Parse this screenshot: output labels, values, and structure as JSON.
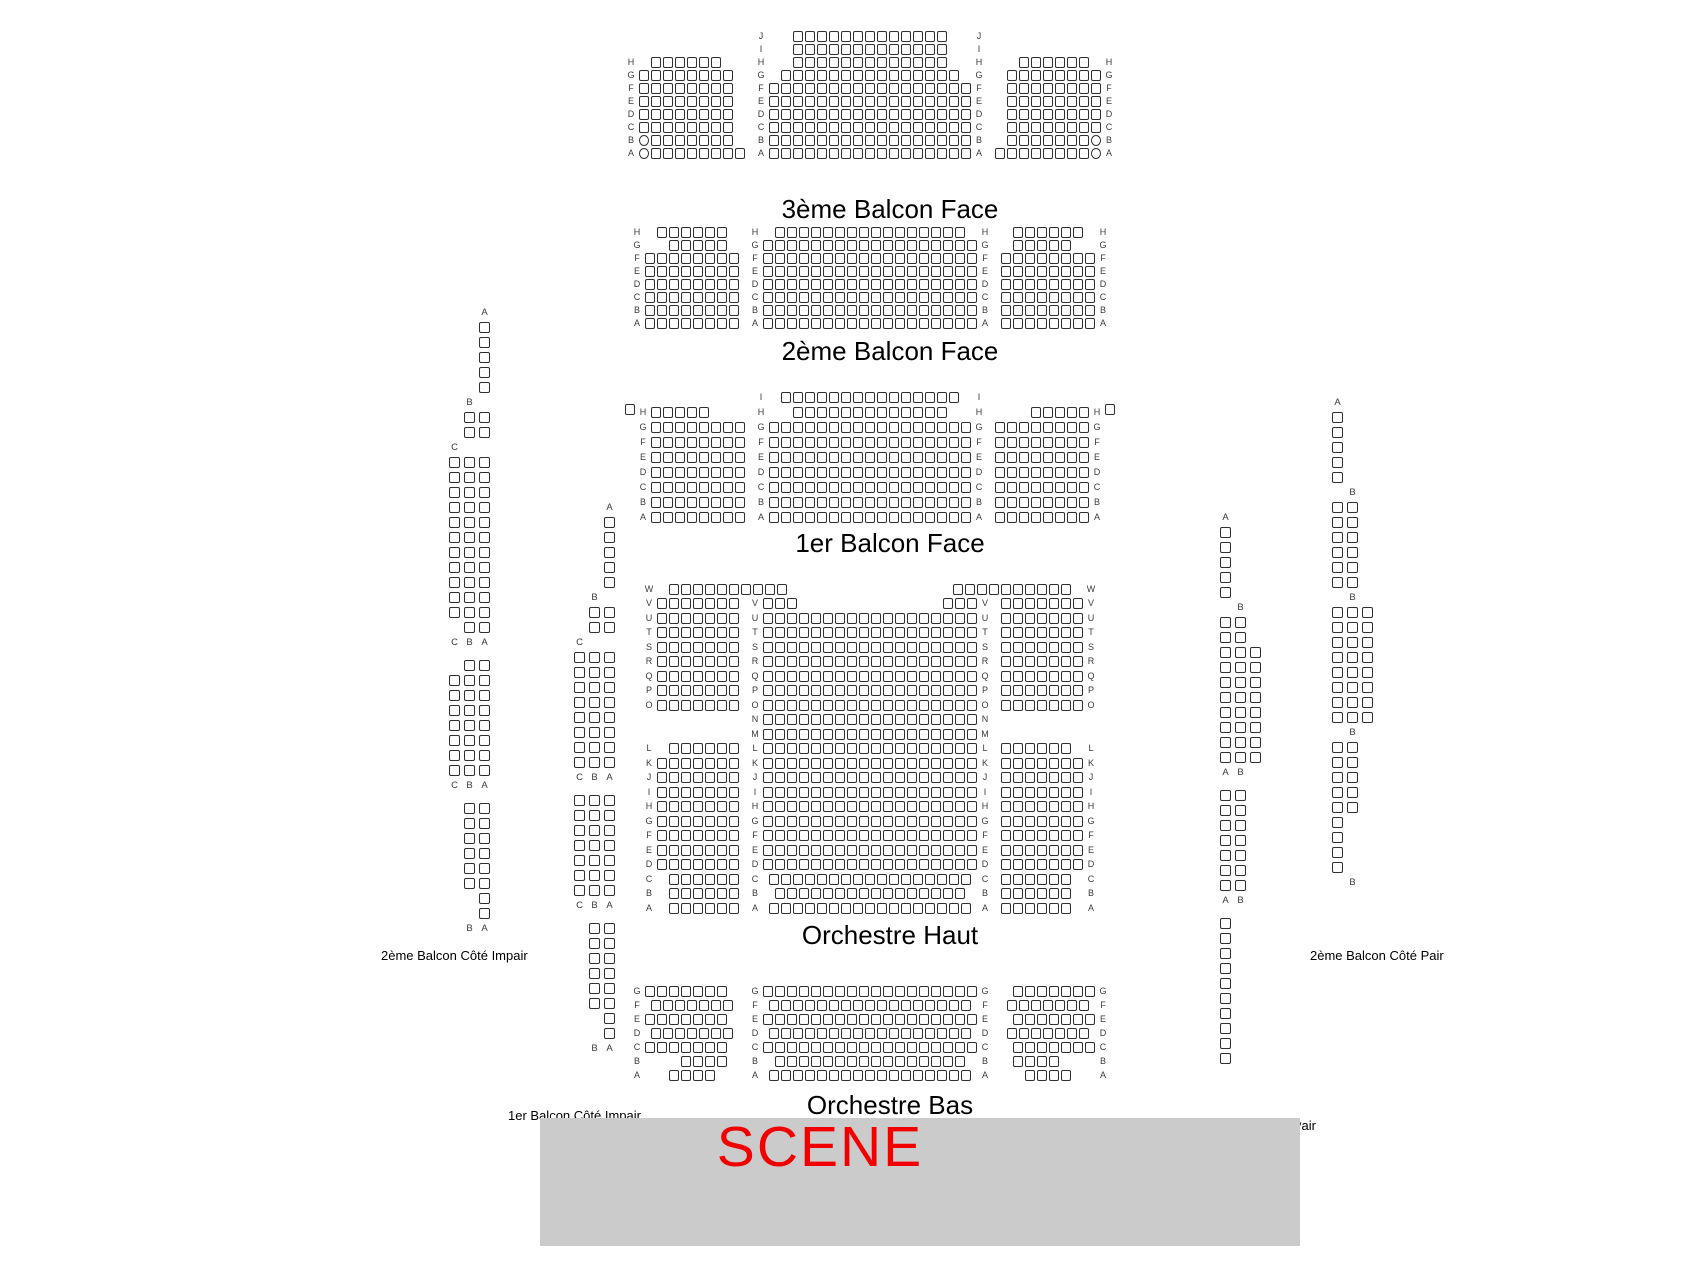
{
  "colors": {
    "stage_bg": "#cbcbcb",
    "scene_red": "#f20000",
    "seat_border": "#2f2f2f"
  },
  "stage": {
    "label": "SCENE"
  },
  "sections": [
    {
      "id": "balcon3",
      "title": "3ème Balcon Face",
      "blocks": [
        {
          "pos": "left",
          "cols": 9,
          "rows": [
            {
              "l": "H",
              "o": 1,
              "n": 6
            },
            {
              "l": "G",
              "n": 8
            },
            {
              "l": "F",
              "n": 8
            },
            {
              "l": "E",
              "n": 8
            },
            {
              "l": "D",
              "n": 8
            },
            {
              "l": "C",
              "n": 8
            },
            {
              "l": "B",
              "n": 7,
              "rl": 1
            },
            {
              "l": "A",
              "n": 8,
              "rl": 1
            }
          ]
        },
        {
          "pos": "center",
          "cols": 17,
          "rows": [
            {
              "l": "J",
              "n": 13
            },
            {
              "l": "I",
              "n": 13
            },
            {
              "l": "H",
              "n": 13
            },
            {
              "l": "G",
              "n": 15
            },
            {
              "l": "F",
              "n": 17
            },
            {
              "l": "E",
              "n": 17
            },
            {
              "l": "D",
              "n": 17
            },
            {
              "l": "C",
              "n": 17
            },
            {
              "l": "B",
              "n": 17
            },
            {
              "l": "A",
              "n": 17
            }
          ]
        },
        {
          "pos": "right",
          "cols": 9,
          "rows": [
            {
              "l": "H",
              "o": 1,
              "n": 6
            },
            {
              "l": "G",
              "n": 8
            },
            {
              "l": "F",
              "n": 8
            },
            {
              "l": "E",
              "n": 8
            },
            {
              "l": "D",
              "n": 8
            },
            {
              "l": "C",
              "n": 8
            },
            {
              "l": "B",
              "n": 7,
              "rr": 1
            },
            {
              "l": "A",
              "n": 8,
              "rr": 1
            }
          ]
        }
      ]
    },
    {
      "id": "balcon2",
      "title": "2ème Balcon Face",
      "blocks": [
        {
          "pos": "left",
          "cols": 8,
          "rows": [
            {
              "l": "H",
              "o": 1,
              "n": 6
            },
            {
              "l": "G",
              "o": 2,
              "n": 5
            },
            {
              "l": "F",
              "n": 8
            },
            {
              "l": "E",
              "n": 8
            },
            {
              "l": "D",
              "n": 8
            },
            {
              "l": "C",
              "n": 8
            },
            {
              "l": "B",
              "n": 8
            },
            {
              "l": "A",
              "n": 8
            }
          ]
        },
        {
          "pos": "center",
          "cols": 18,
          "rows": [
            {
              "l": "H",
              "n": 16
            },
            {
              "l": "G",
              "n": 18
            },
            {
              "l": "F",
              "n": 18
            },
            {
              "l": "E",
              "n": 18
            },
            {
              "l": "D",
              "n": 18
            },
            {
              "l": "C",
              "n": 18
            },
            {
              "l": "B",
              "n": 18
            },
            {
              "l": "A",
              "n": 18
            }
          ]
        },
        {
          "pos": "right",
          "cols": 8,
          "rows": [
            {
              "l": "H",
              "o": 1,
              "n": 6
            },
            {
              "l": "G",
              "o": 2,
              "n": 5
            },
            {
              "l": "F",
              "n": 8
            },
            {
              "l": "E",
              "n": 8
            },
            {
              "l": "D",
              "n": 8
            },
            {
              "l": "C",
              "n": 8
            },
            {
              "l": "B",
              "n": 8
            },
            {
              "l": "A",
              "n": 8
            }
          ]
        }
      ]
    },
    {
      "id": "balcon1",
      "title": "1er Balcon Face",
      "lone_seats": 2,
      "blocks": [
        {
          "pos": "left",
          "cols": 8,
          "rows": [
            {
              "l": "H",
              "n": 5
            },
            {
              "l": "G",
              "n": 8
            },
            {
              "l": "F",
              "n": 8
            },
            {
              "l": "E",
              "n": 8
            },
            {
              "l": "D",
              "n": 8
            },
            {
              "l": "C",
              "n": 8
            },
            {
              "l": "B",
              "n": 8
            },
            {
              "l": "A",
              "n": 8
            }
          ]
        },
        {
          "pos": "center",
          "cols": 17,
          "rows": [
            {
              "l": "I",
              "n": 15
            },
            {
              "l": "H",
              "n": 13
            },
            {
              "l": "G",
              "n": 17
            },
            {
              "l": "F",
              "n": 17
            },
            {
              "l": "E",
              "n": 17
            },
            {
              "l": "D",
              "n": 17
            },
            {
              "l": "C",
              "n": 17
            },
            {
              "l": "B",
              "n": 17
            },
            {
              "l": "A",
              "n": 17
            }
          ]
        },
        {
          "pos": "right",
          "cols": 8,
          "rows": [
            {
              "l": "H",
              "n": 5
            },
            {
              "l": "G",
              "n": 8
            },
            {
              "l": "F",
              "n": 8
            },
            {
              "l": "E",
              "n": 8
            },
            {
              "l": "D",
              "n": 8
            },
            {
              "l": "C",
              "n": 8
            },
            {
              "l": "B",
              "n": 8
            },
            {
              "l": "A",
              "n": 8
            }
          ]
        }
      ]
    },
    {
      "id": "orch-haut",
      "title": "Orchestre Haut",
      "blocks": [
        {
          "pos": "left",
          "cols": 7,
          "rows": [
            {
              "l": "W",
              "o": 1,
              "n": 10
            },
            {
              "l": "V",
              "n": 7
            },
            {
              "l": "U",
              "n": 7
            },
            {
              "l": "T",
              "n": 7
            },
            {
              "l": "S",
              "n": 7
            },
            {
              "l": "R",
              "n": 7
            },
            {
              "l": "Q",
              "n": 7
            },
            {
              "l": "P",
              "n": 7
            },
            {
              "l": "O",
              "n": 7
            },
            {
              "sp": 2
            },
            {
              "l": "L",
              "o": 1,
              "n": 6
            },
            {
              "l": "K",
              "n": 7
            },
            {
              "l": "J",
              "n": 7
            },
            {
              "l": "I",
              "n": 7
            },
            {
              "l": "H",
              "n": 7
            },
            {
              "l": "G",
              "n": 7
            },
            {
              "l": "F",
              "n": 7
            },
            {
              "l": "E",
              "n": 7
            },
            {
              "l": "D",
              "n": 7
            },
            {
              "l": "C",
              "o": 1,
              "n": 6
            },
            {
              "l": "B",
              "o": 1,
              "n": 6
            },
            {
              "l": "A",
              "o": 1,
              "n": 6
            }
          ]
        },
        {
          "pos": "center",
          "cols": 18,
          "rows": [
            {
              "l": "V",
              "split": [
                3,
                3
              ]
            },
            {
              "l": "U",
              "n": 18
            },
            {
              "l": "T",
              "n": 18
            },
            {
              "l": "S",
              "n": 18
            },
            {
              "l": "R",
              "n": 18
            },
            {
              "l": "Q",
              "n": 18
            },
            {
              "l": "P",
              "n": 18
            },
            {
              "l": "O",
              "n": 18
            },
            {
              "l": "N",
              "n": 18
            },
            {
              "l": "M",
              "n": 18
            },
            {
              "l": "L",
              "n": 18
            },
            {
              "l": "K",
              "n": 18
            },
            {
              "l": "J",
              "n": 18
            },
            {
              "l": "I",
              "n": 18
            },
            {
              "l": "H",
              "n": 18
            },
            {
              "l": "G",
              "n": 18
            },
            {
              "l": "F",
              "n": 18
            },
            {
              "l": "E",
              "n": 18
            },
            {
              "l": "D",
              "n": 18
            },
            {
              "l": "C",
              "n": 17
            },
            {
              "l": "B",
              "n": 16
            },
            {
              "l": "A",
              "n": 17
            }
          ]
        },
        {
          "pos": "right",
          "cols": 7,
          "rows": [
            {
              "l": "W",
              "o": 1,
              "n": 10
            },
            {
              "l": "V",
              "n": 7
            },
            {
              "l": "U",
              "n": 7
            },
            {
              "l": "T",
              "n": 7
            },
            {
              "l": "S",
              "n": 7
            },
            {
              "l": "R",
              "n": 7
            },
            {
              "l": "Q",
              "n": 7
            },
            {
              "l": "P",
              "n": 7
            },
            {
              "l": "O",
              "n": 7
            },
            {
              "sp": 2
            },
            {
              "l": "L",
              "o": 1,
              "n": 6
            },
            {
              "l": "K",
              "n": 7
            },
            {
              "l": "J",
              "n": 7
            },
            {
              "l": "I",
              "n": 7
            },
            {
              "l": "H",
              "n": 7
            },
            {
              "l": "G",
              "n": 7
            },
            {
              "l": "F",
              "n": 7
            },
            {
              "l": "E",
              "n": 7
            },
            {
              "l": "D",
              "n": 7
            },
            {
              "l": "C",
              "o": 1,
              "n": 6
            },
            {
              "l": "B",
              "o": 1,
              "n": 6
            },
            {
              "l": "A",
              "o": 1,
              "n": 6
            }
          ]
        }
      ]
    },
    {
      "id": "orch-bas",
      "title": "Orchestre Bas",
      "blocks": [
        {
          "pos": "left",
          "cols": 8,
          "rows": [
            {
              "l": "G",
              "n": 7
            },
            {
              "l": "F",
              "o": 0.5,
              "n": 7
            },
            {
              "l": "E",
              "n": 7
            },
            {
              "l": "D",
              "o": 0.5,
              "n": 7
            },
            {
              "l": "C",
              "n": 7
            },
            {
              "l": "B",
              "o": 3,
              "n": 4
            },
            {
              "l": "A",
              "o": 2,
              "n": 4
            }
          ]
        },
        {
          "pos": "center",
          "cols": 18,
          "rows": [
            {
              "l": "G",
              "n": 18
            },
            {
              "l": "F",
              "n": 17
            },
            {
              "l": "E",
              "n": 18
            },
            {
              "l": "D",
              "n": 17
            },
            {
              "l": "C",
              "n": 18
            },
            {
              "l": "B",
              "n": 16
            },
            {
              "l": "A",
              "n": 17
            }
          ]
        },
        {
          "pos": "right",
          "cols": 8,
          "rows": [
            {
              "l": "G",
              "n": 7
            },
            {
              "l": "F",
              "o": 0.5,
              "n": 7
            },
            {
              "l": "E",
              "n": 7
            },
            {
              "l": "D",
              "o": 0.5,
              "n": 7
            },
            {
              "l": "C",
              "n": 7
            },
            {
              "l": "B",
              "o": 3,
              "n": 4
            },
            {
              "l": "A",
              "o": 2,
              "n": 4
            }
          ]
        }
      ]
    }
  ],
  "strips": [
    {
      "id": "imp2",
      "title": "2ème Balcon Côté Impair",
      "items": [
        {
          "t": "lab",
          "ls": [
            "A"
          ],
          "dx": 0
        },
        {
          "t": "rows",
          "w": 1,
          "c": 5
        },
        {
          "t": "lab",
          "ls": [
            "B"
          ],
          "dx": 1
        },
        {
          "t": "rows",
          "w": 2,
          "c": 2
        },
        {
          "t": "lab",
          "ls": [
            "C"
          ],
          "dx": 2
        },
        {
          "t": "rows",
          "w": 3,
          "c": 11
        },
        {
          "t": "rows",
          "w": 2,
          "c": 1
        },
        {
          "t": "lab",
          "ls": [
            "C",
            "B",
            "A"
          ]
        },
        {
          "t": "gap"
        },
        {
          "t": "rows",
          "w": 2,
          "c": 1
        },
        {
          "t": "rows",
          "w": 3,
          "c": 7
        },
        {
          "t": "lab",
          "ls": [
            "C",
            "B",
            "A"
          ]
        },
        {
          "t": "gap"
        },
        {
          "t": "rows",
          "w": 2,
          "c": 6
        },
        {
          "t": "rows",
          "w": 1,
          "c": 2
        },
        {
          "t": "lab",
          "ls": [
            "B",
            "A"
          ]
        }
      ]
    },
    {
      "id": "imp1",
      "title": "1er Balcon Côté Impair",
      "items": [
        {
          "t": "lab",
          "ls": [
            "A"
          ],
          "dx": 0
        },
        {
          "t": "rows",
          "w": 1,
          "c": 5
        },
        {
          "t": "lab",
          "ls": [
            "B"
          ],
          "dx": 1
        },
        {
          "t": "rows",
          "w": 2,
          "c": 2
        },
        {
          "t": "lab",
          "ls": [
            "C"
          ],
          "dx": 2
        },
        {
          "t": "rows",
          "w": 3,
          "c": 8
        },
        {
          "t": "lab",
          "ls": [
            "C",
            "B",
            "A"
          ]
        },
        {
          "t": "gap"
        },
        {
          "t": "rows",
          "w": 3,
          "c": 7
        },
        {
          "t": "lab",
          "ls": [
            "C",
            "B",
            "A"
          ]
        },
        {
          "t": "gap"
        },
        {
          "t": "rows",
          "w": 2,
          "c": 6
        },
        {
          "t": "rows",
          "w": 1,
          "c": 2
        },
        {
          "t": "lab",
          "ls": [
            "B",
            "A"
          ]
        }
      ]
    },
    {
      "id": "pair1",
      "title": "1er Balcon Côté Pair",
      "items": [
        {
          "t": "lab",
          "ls": [
            "A"
          ],
          "dx": 0
        },
        {
          "t": "rows",
          "w": 1,
          "c": 5
        },
        {
          "t": "lab",
          "ls": [
            "B"
          ],
          "dx": 1
        },
        {
          "t": "rows",
          "w": 2,
          "c": 2
        },
        {
          "t": "rows",
          "w": 3,
          "c": 8
        },
        {
          "t": "lab",
          "ls": [
            "A",
            "B"
          ]
        },
        {
          "t": "gap"
        },
        {
          "t": "rows",
          "w": 2,
          "c": 7
        },
        {
          "t": "lab",
          "ls": [
            "A",
            "B"
          ]
        },
        {
          "t": "gap"
        },
        {
          "t": "rows",
          "w": 1,
          "c": 10
        }
      ]
    },
    {
      "id": "pair2",
      "title": "2ème Balcon Côté Pair",
      "items": [
        {
          "t": "lab",
          "ls": [
            "A"
          ],
          "dx": 0
        },
        {
          "t": "rows",
          "w": 1,
          "c": 5
        },
        {
          "t": "lab",
          "ls": [
            "B"
          ],
          "dx": 1
        },
        {
          "t": "rows",
          "w": 2,
          "c": 6
        },
        {
          "t": "lab",
          "ls": [
            "B"
          ],
          "dx": 1
        },
        {
          "t": "rows",
          "w": 3,
          "c": 8
        },
        {
          "t": "lab",
          "ls": [
            "B"
          ],
          "dx": 1
        },
        {
          "t": "rows",
          "w": 2,
          "c": 5
        },
        {
          "t": "rows",
          "w": 1,
          "c": 4
        },
        {
          "t": "lab",
          "ls": [
            "B"
          ],
          "dx": 1
        }
      ]
    }
  ]
}
